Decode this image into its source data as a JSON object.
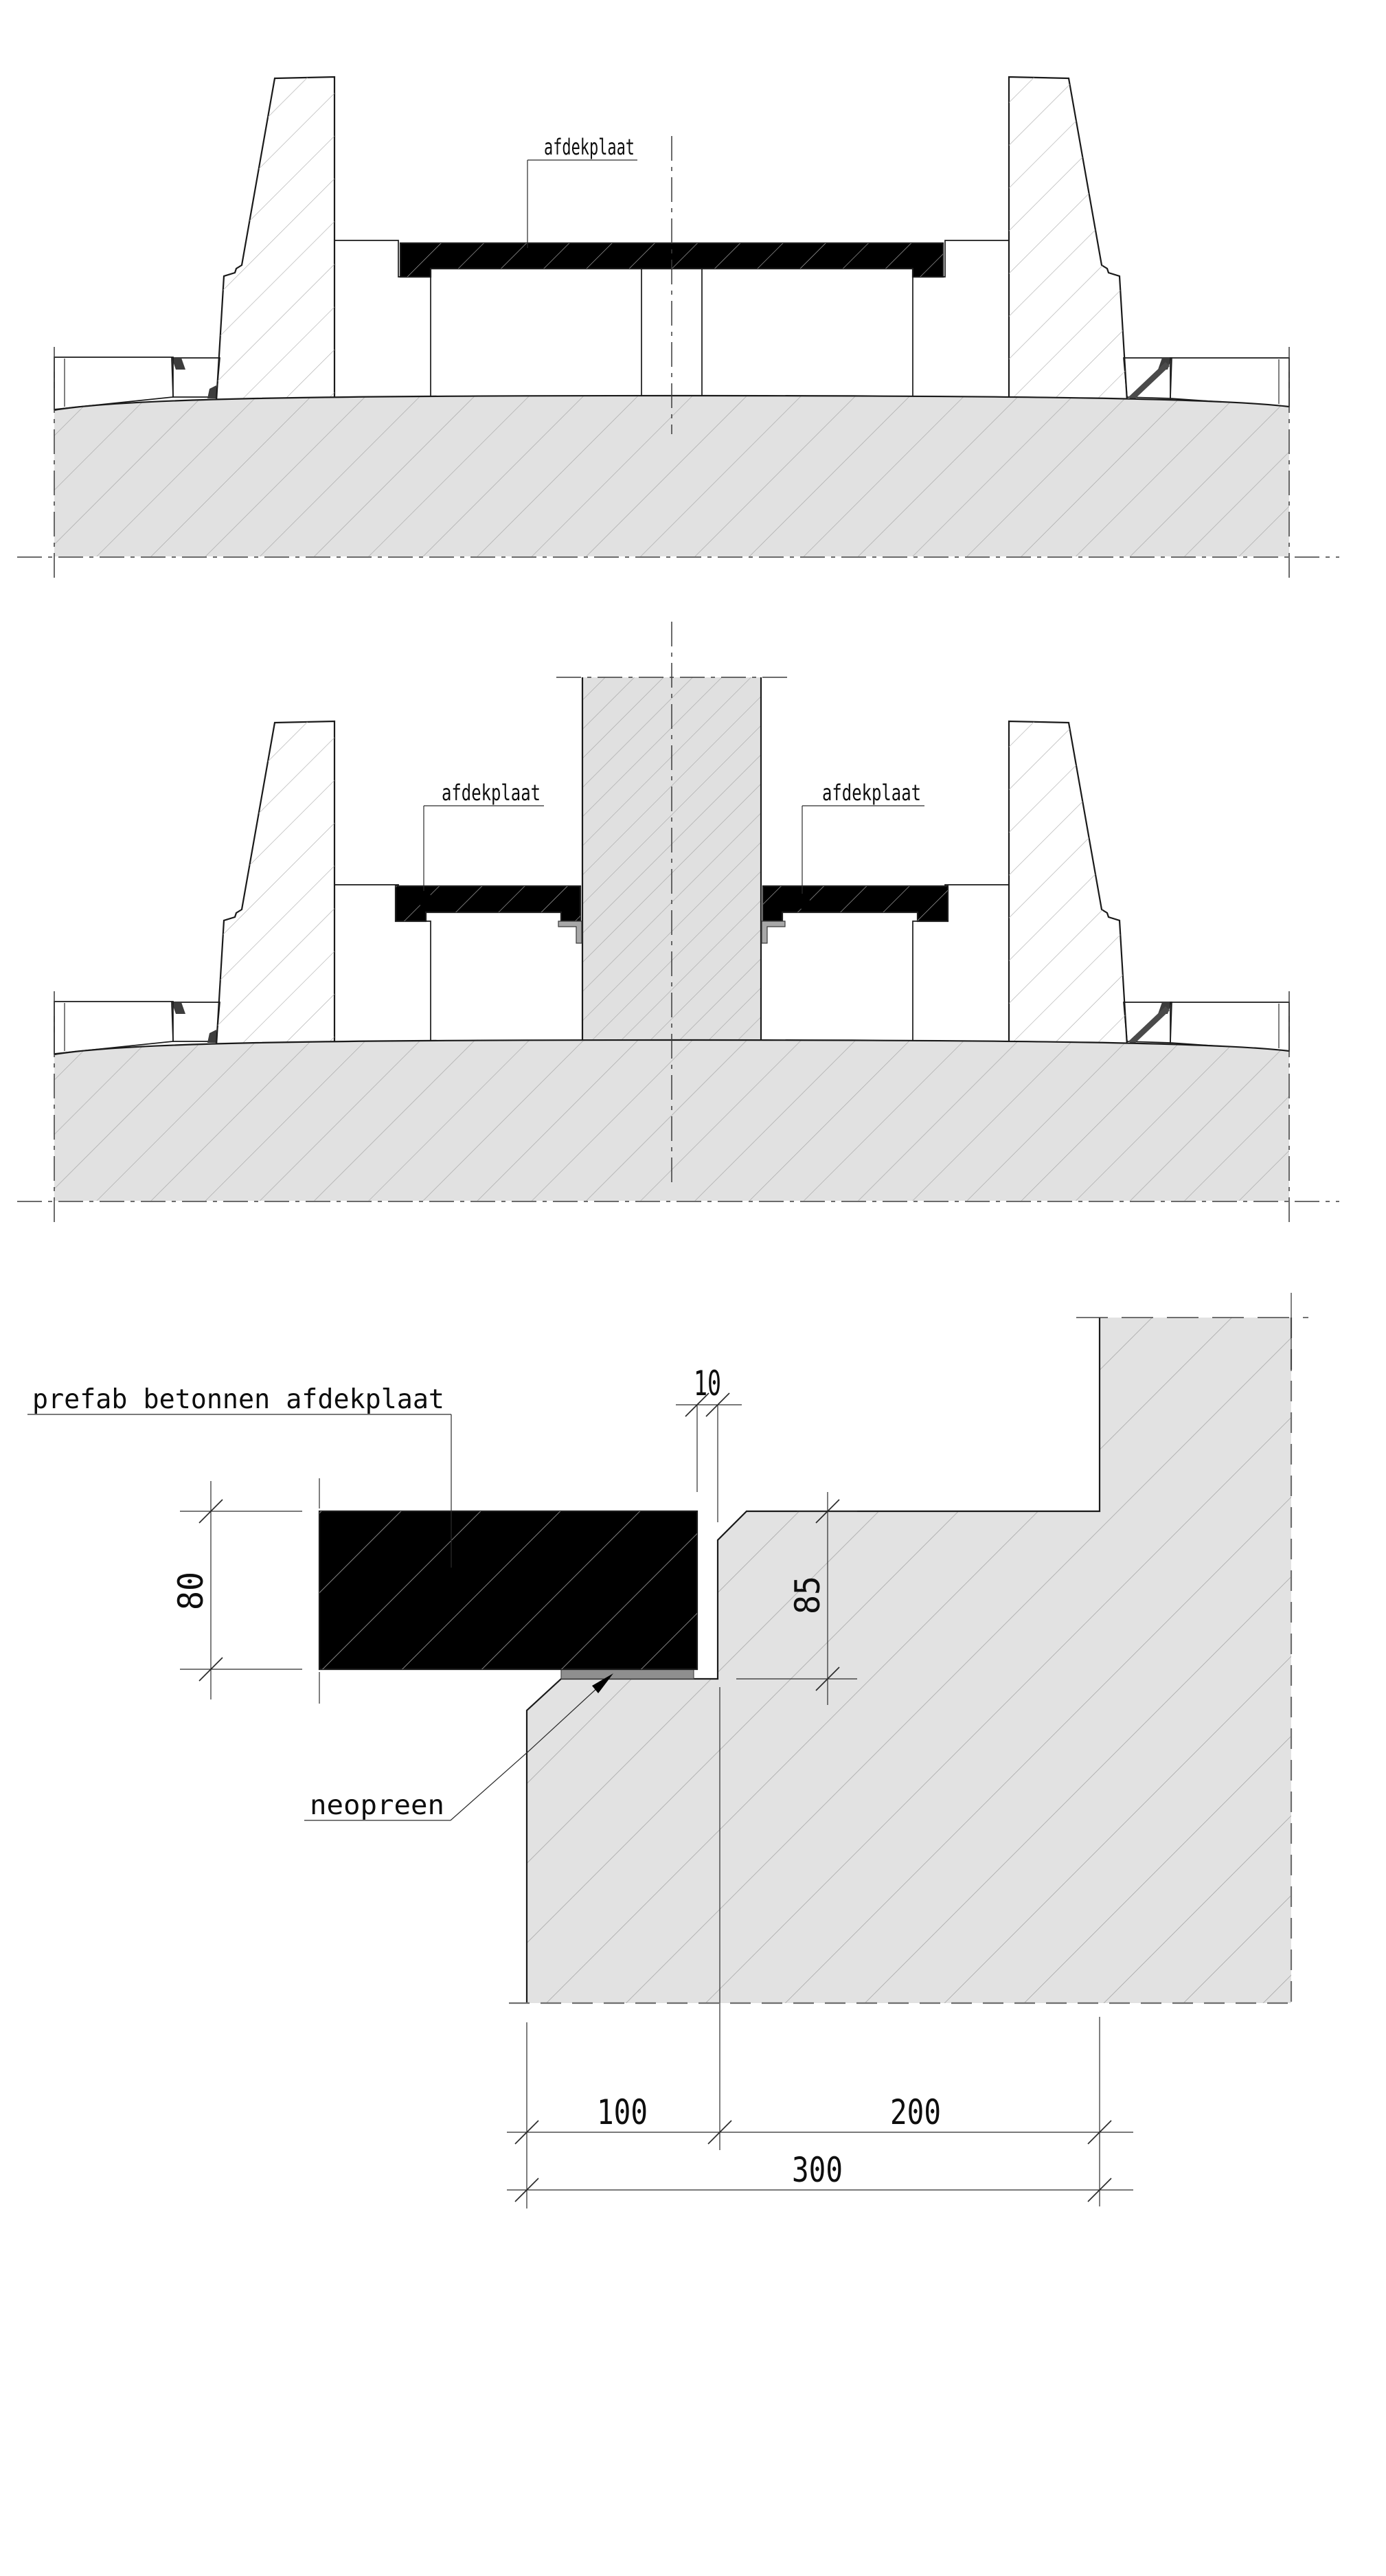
{
  "drawing": {
    "background_color": "#ffffff",
    "ink_color": "#1a1a1a",
    "concrete_fill": "#e1e1e1",
    "precast_fill": "#e5e5e5",
    "neoprene_color": "#8f8f8f",
    "joint_seal_color": "#3d3d3d",
    "sections": {
      "section1": {
        "labels": {
          "cover_plate": "afdekplaat"
        }
      },
      "section2": {
        "labels": {
          "cover_plate_left": "afdekplaat",
          "cover_plate_right": "afdekplaat"
        }
      },
      "detail": {
        "labels": {
          "prefab_plate": "prefab betonnen afdekplaat",
          "neoprene": "neopreen"
        },
        "dimensions": {
          "joint_gap": "10",
          "plate_thickness": "80",
          "rebate_depth": "85",
          "seat_width": "100",
          "wall_width": "200",
          "total_width": "300"
        }
      }
    }
  }
}
